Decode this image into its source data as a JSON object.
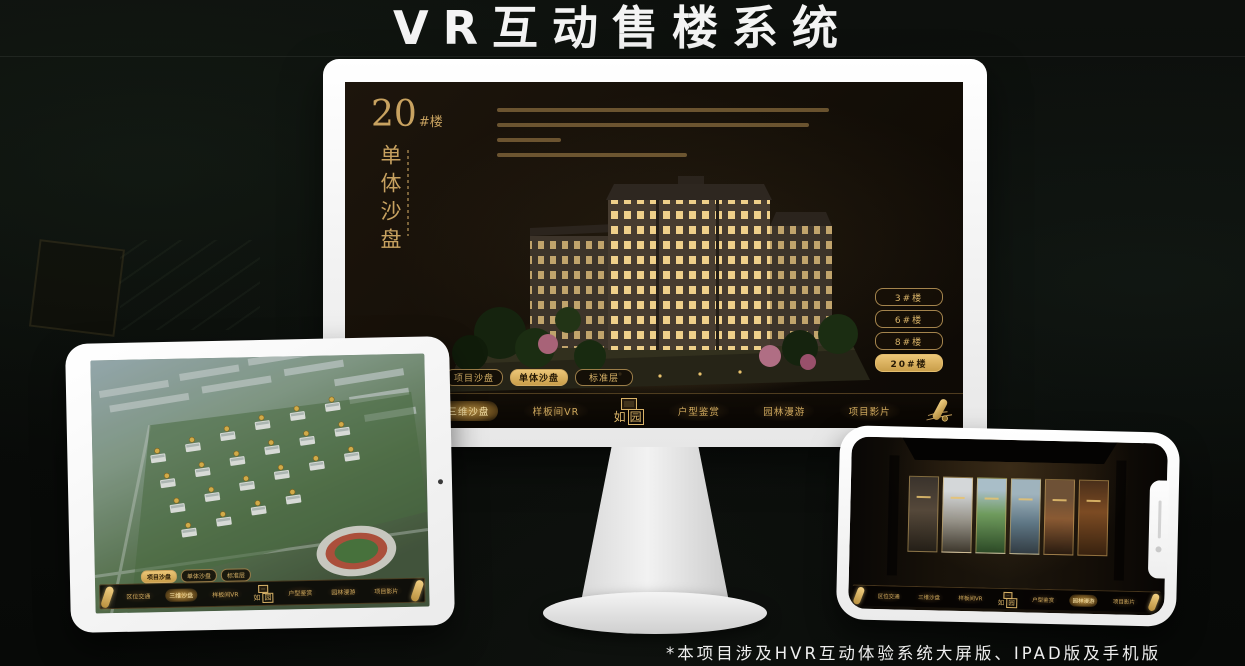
{
  "page": {
    "title": "VR互动售楼系统",
    "footnote": "*本项目涉及HVR互动体验系统大屏版、IPAD版及手机版"
  },
  "project": {
    "logo_char1": "如",
    "logo_char2": "园"
  },
  "nav": {
    "items": [
      "区位交通",
      "三维沙盘",
      "样板间VR",
      "户型鉴赏",
      "园林漫游",
      "项目影片"
    ]
  },
  "mode_tabs": [
    "项目沙盘",
    "单体沙盘",
    "标准层"
  ],
  "monitor": {
    "heading_number": "20",
    "heading_suffix": "#楼",
    "heading_vertical": "单体沙盘",
    "floor_buttons": [
      "3#楼",
      "6#楼",
      "8#楼",
      "20#楼"
    ],
    "active_floor": "20#楼",
    "active_mode_tab": "单体沙盘",
    "active_nav_item": "三维沙盘"
  },
  "ipad": {
    "active_mode_tab": "项目沙盘",
    "active_nav_item": "三维沙盘"
  },
  "phone": {
    "active_nav_item": "园林漫游"
  },
  "icons": {
    "scroll": "scroll-icon (rolled gold scroll, menu handle)",
    "roll_handle": "roll-handle-icon (gold rolled end of nav bar)",
    "camera": "camera-icon (device front camera dot)",
    "speaker": "speaker-slit-icon (phone earpiece)"
  },
  "colors": {
    "gold": "#c9a35f",
    "gold_bright": "#ecc677",
    "screen_bg": "#130e07",
    "title_white": "#f4f4f4"
  }
}
